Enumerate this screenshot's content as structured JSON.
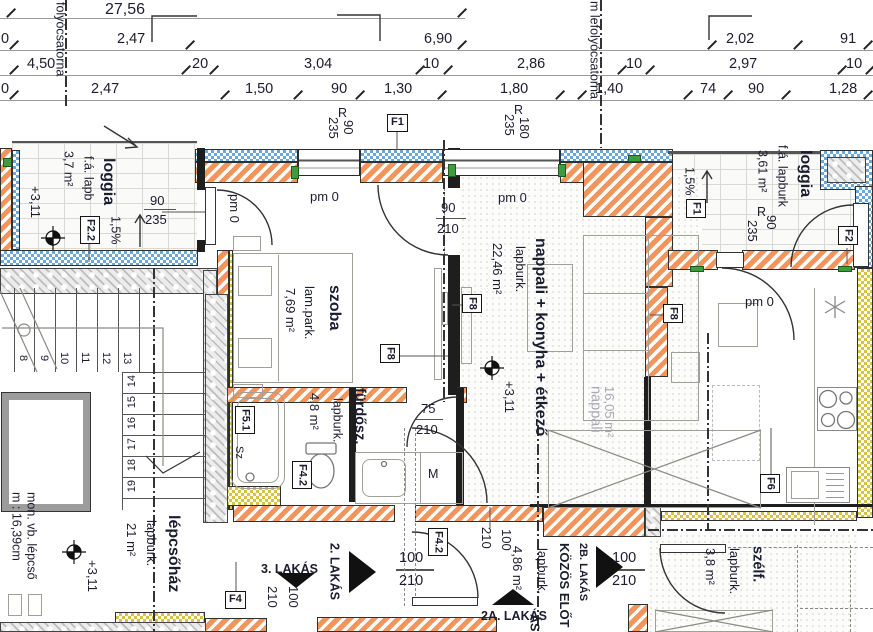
{
  "dims": {
    "total": "27,56",
    "row2": [
      "0",
      "2,47",
      "6,90",
      "2,02",
      "91"
    ],
    "row3": [
      "4,50",
      "20",
      "3,04",
      "10",
      "2,86",
      "10",
      "2,97",
      "10"
    ],
    "row4": [
      "0",
      "2,47",
      "1,50",
      "90",
      "1,30",
      "1,80",
      "1,40",
      "74",
      "90",
      "1,28"
    ]
  },
  "drains": {
    "left": "folyócsatorna",
    "right": "m lefolyócsatorna"
  },
  "marks": {
    "r": "R",
    "pm0": "pm 0",
    "slope": "1,5%",
    "level": "+3,11"
  },
  "sizes": {
    "s75": "75",
    "s90": "90",
    "s100": "100",
    "s180": "180",
    "s210": "210",
    "s235": "235"
  },
  "rooms": {
    "loggia_left": {
      "name": "loggia",
      "area": "3,7 m²",
      "floor": "f.á. lapb"
    },
    "loggia_right": {
      "name": "loggia",
      "area": "3,61 m²",
      "floor": "f.á. lapburk"
    },
    "szoba": {
      "name": "szoba",
      "floor": "lam.park.",
      "area": "7,69 m²"
    },
    "nappali": {
      "name": "nappali + konyha + étkező",
      "floor": "lapburk.",
      "area": "22,46 m²"
    },
    "nappali_ghost": {
      "name": "nappali",
      "area": "16,05 m²"
    },
    "furdoszoba": {
      "name": "fürdősz.",
      "area": "4,8 m²",
      "floor": "lapburk."
    },
    "lepcsohaz": {
      "name": "lépcsőház",
      "area": "21 m²",
      "floor": "lapburk.",
      "note_stair": "mon. vb. lépcső",
      "note_rise": "m : 16,39cm"
    },
    "szelfogo": {
      "name": "szélf.",
      "area": "3,8 m²",
      "floor": "lapburk."
    },
    "eloter": {
      "area": "4,86 m²",
      "floor": "lapburk."
    }
  },
  "tags": {
    "f1": "F1",
    "f2": "F2",
    "f22": "F2.2",
    "f4": "F4",
    "f42": "F4.2",
    "f51": "F5.1",
    "f6": "F6",
    "f8": "F8"
  },
  "apartments": {
    "a3": "3. LAKÁS",
    "a2": "2. LAKÁS",
    "a2a": "2A. LAKÁS",
    "a2b": "2B. LAKÁS",
    "kozos": "KÖZÖS ELŐT",
    "cut": "ÁS"
  },
  "stairs": {
    "flight1": [
      "8",
      "9",
      "10",
      "11",
      "12",
      "13"
    ],
    "flight2": [
      "14",
      "15",
      "16",
      "17",
      "18",
      "19"
    ]
  },
  "fixtures": {
    "washer": "M",
    "tub": "Sz"
  },
  "colors": {
    "insulation": "#f2955c",
    "masonry": "#5f9fd6",
    "partition": "#d9c23f",
    "green": "#3f9b3f"
  }
}
